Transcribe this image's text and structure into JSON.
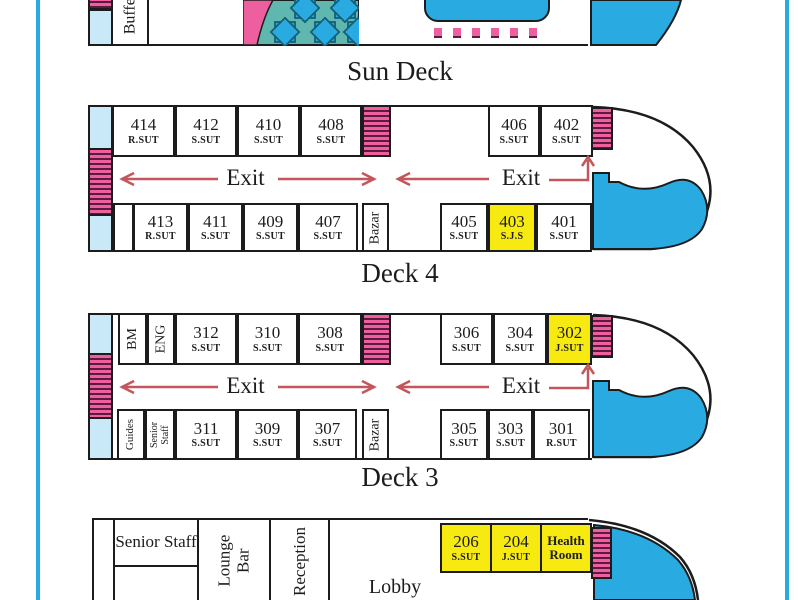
{
  "colors": {
    "water_blue": "#29abe2",
    "cabin_blue": "#c9e8f8",
    "stair_pink": "#ee5f9f",
    "stair_stripe": "#5c1a3e",
    "highlight_yellow": "#f7ea11",
    "pattern_teal": "#5fb7af",
    "arrow_red": "#c4555a",
    "outline_black": "#1c1c1c"
  },
  "sun_deck": {
    "label": "Sun Deck",
    "buffet": "Buffet"
  },
  "deck4": {
    "label": "Deck 4",
    "exit_left": "Exit",
    "exit_right": "Exit",
    "bazar": "Bazar",
    "top_rooms": [
      {
        "number": "414",
        "type": "R.SUT"
      },
      {
        "number": "412",
        "type": "S.SUT"
      },
      {
        "number": "410",
        "type": "S.SUT"
      },
      {
        "number": "408",
        "type": "S.SUT"
      }
    ],
    "fwd_top_rooms": [
      {
        "number": "406",
        "type": "S.SUT"
      },
      {
        "number": "402",
        "type": "S.SUT"
      }
    ],
    "bottom_rooms": [
      {
        "number": "413",
        "type": "R.SUT"
      },
      {
        "number": "411",
        "type": "S.SUT"
      },
      {
        "number": "409",
        "type": "S.SUT"
      },
      {
        "number": "407",
        "type": "S.SUT"
      }
    ],
    "fwd_bottom_rooms": [
      {
        "number": "405",
        "type": "S.SUT"
      },
      {
        "number": "403",
        "type": "S.J.S"
      },
      {
        "number": "401",
        "type": "S.SUT"
      }
    ]
  },
  "deck3": {
    "label": "Deck 3",
    "exit_left": "Exit",
    "exit_right": "Exit",
    "bazar": "Bazar",
    "bm": "BM",
    "eng": "ENG",
    "guides": "Guides",
    "senior_staff": "Senior\nStaff",
    "top_rooms": [
      {
        "number": "312",
        "type": "S.SUT"
      },
      {
        "number": "310",
        "type": "S.SUT"
      },
      {
        "number": "308",
        "type": "S.SUT"
      }
    ],
    "fwd_top_rooms": [
      {
        "number": "306",
        "type": "S.SUT"
      },
      {
        "number": "304",
        "type": "S.SUT"
      },
      {
        "number": "302",
        "type": "J.SUT"
      }
    ],
    "bottom_rooms": [
      {
        "number": "311",
        "type": "S.SUT"
      },
      {
        "number": "309",
        "type": "S.SUT"
      },
      {
        "number": "307",
        "type": "S.SUT"
      }
    ],
    "fwd_bottom_rooms": [
      {
        "number": "305",
        "type": "S.SUT"
      },
      {
        "number": "303",
        "type": "S.SUT"
      },
      {
        "number": "301",
        "type": "R.SUT"
      }
    ]
  },
  "deck2": {
    "senior_staff": "Senior Staff",
    "lounge_bar": "Lounge\nBar",
    "reception": "Reception",
    "lobby": "Lobby",
    "health_room": "Health Room",
    "rooms": [
      {
        "number": "206",
        "type": "S.SUT"
      },
      {
        "number": "204",
        "type": "J.SUT"
      }
    ]
  }
}
